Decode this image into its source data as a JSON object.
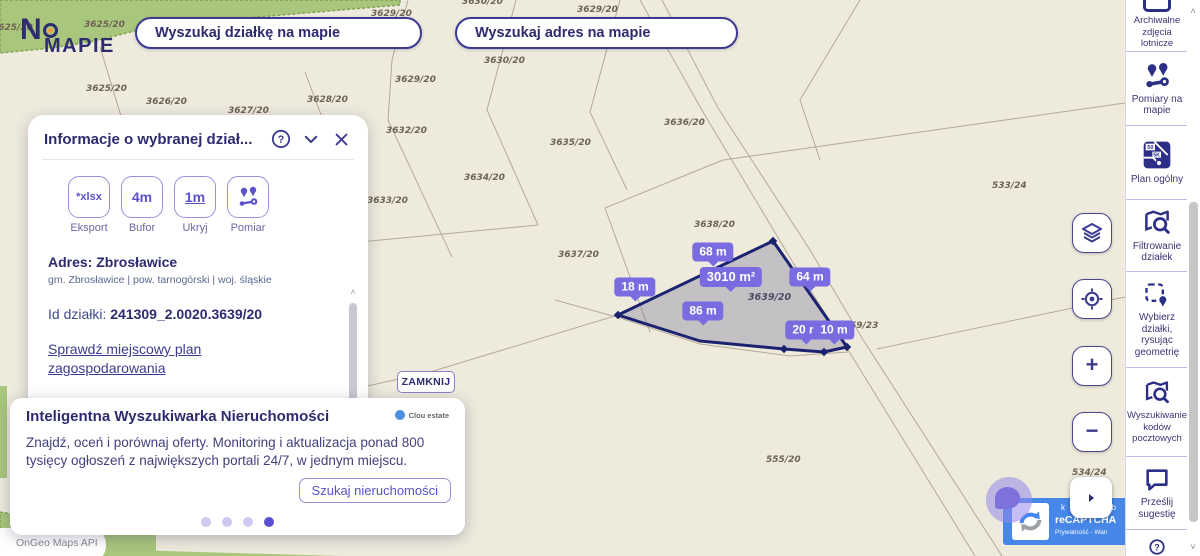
{
  "logo": {
    "part1": "N",
    "part2": "MAPIE"
  },
  "search": {
    "parcel": "Wyszukaj działkę na mapie",
    "address": "Wyszukaj adres na mapie"
  },
  "panel": {
    "title": "Informacje o wybranej dział...",
    "tools": [
      {
        "glyph": "*xlsx",
        "caption": "Eksport"
      },
      {
        "glyph": "4m",
        "caption": "Bufor"
      },
      {
        "glyph": "1m",
        "caption": "Ukryj"
      },
      {
        "caption": "Pomiar"
      }
    ],
    "address_label": "Adres:",
    "address_value": "Zbrosławice",
    "address_sub": "gm. Zbrosławice | pow. tarnogórski | woj. śląskie",
    "id_label": "Id działki:",
    "id_value": "241309_2.0020.3639/20",
    "link_plan": "Sprawdź miejscowy plan zagospodarowania",
    "link_media": "Sprawdź uzbrojenie terenu w media"
  },
  "close_button": "ZAMKNIJ",
  "promo": {
    "title": "Inteligentna Wyszukiwarka Nieruchomości",
    "brand": "Clou estate",
    "body": "Znajdź, oceń i porównaj oferty. Monitoring i aktualizacja ponad 800 tysięcy ogłoszeń z największych portali 24/7, w jednym miejscu.",
    "cta": "Szukaj nieruchomości"
  },
  "sidebar": {
    "items": [
      {
        "label": "Archiwalne zdjęcia lotnicze"
      },
      {
        "label": "Pomiary na mapie"
      },
      {
        "label": "Plan ogólny"
      },
      {
        "label": "Filtrowanie działek"
      },
      {
        "label": "Wybierz działki, rysując geometrię"
      },
      {
        "label": "Wyszukiwanie kodów pocztowych"
      },
      {
        "label": "Prześlij sugestię"
      }
    ],
    "plan_icon_labels": [
      "50",
      "5K"
    ]
  },
  "map": {
    "selected_parcel": {
      "number": "3639/20",
      "area": "3010 m²"
    },
    "labels": [
      {
        "text": "3625/20"
      },
      {
        "text": "3625/20"
      },
      {
        "text": "3625/20"
      },
      {
        "text": "3626/20"
      },
      {
        "text": "3627/20"
      },
      {
        "text": "3628/20"
      },
      {
        "text": "3629/20"
      },
      {
        "text": "3629/20"
      },
      {
        "text": "3630/20"
      },
      {
        "text": "3630/20"
      },
      {
        "text": "3629/20"
      },
      {
        "text": "3632/20"
      },
      {
        "text": "3633/20"
      },
      {
        "text": "3634/20"
      },
      {
        "text": "3635/20"
      },
      {
        "text": "3636/20"
      },
      {
        "text": "3637/20"
      },
      {
        "text": "3638/20"
      },
      {
        "text": "533/24"
      },
      {
        "text": "59/23"
      },
      {
        "text": "555/20"
      },
      {
        "text": "534/24"
      }
    ],
    "measurements": [
      {
        "text": "18 m"
      },
      {
        "text": "68 m"
      },
      {
        "text": "3010 m²"
      },
      {
        "text": "64 m"
      },
      {
        "text": "86 m"
      },
      {
        "text": "20 m"
      },
      {
        "text": "10 m"
      }
    ]
  },
  "controls": {
    "zoom_in": "+",
    "zoom_out": "−"
  },
  "recaptcha": {
    "frag_left": "k",
    "frag_right": "zab",
    "brand": "reCAPTCHA",
    "privacy": "Prywatność - Wan"
  },
  "attribution": "OnGeo Maps API",
  "icons": {
    "question": "?"
  },
  "colors": {
    "navy": "#2e2b70",
    "purple": "#5b51c9",
    "measure_purple": "#7a6be0",
    "green": "#a8c67c",
    "recaptcha_blue": "#4687e8",
    "parcel_stroke": "#1b2370"
  }
}
